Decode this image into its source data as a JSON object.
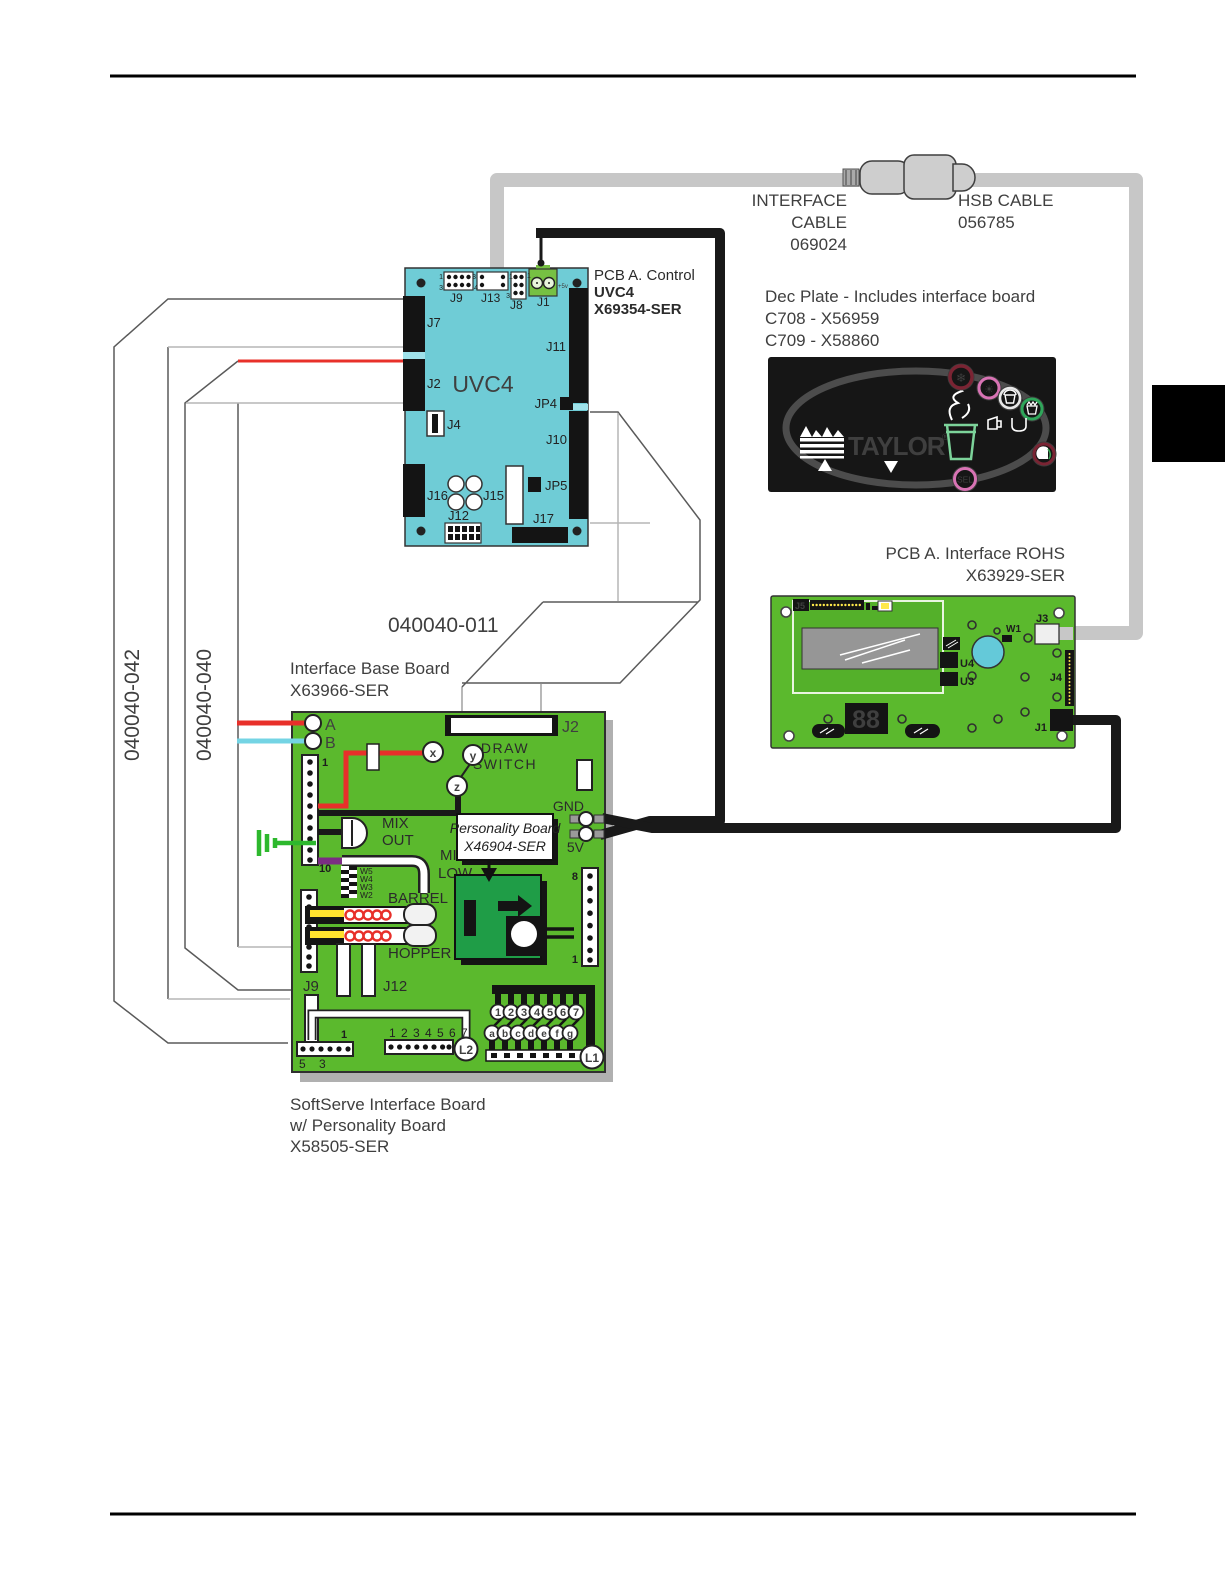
{
  "page": {
    "labels": {
      "harness_outer": "040040-042",
      "harness_inner": "040040-040",
      "harness_011": "040040-011"
    }
  },
  "cables": {
    "interface": {
      "line1": "INTERFACE",
      "line2": "CABLE",
      "line3": "069024"
    },
    "hsb": {
      "line1": "HSB CABLE",
      "line2": "056785"
    }
  },
  "uvc4": {
    "title1": "PCB A. Control",
    "title2": "UVC4",
    "title3": "X69354-SER",
    "chip_label": "UVC4",
    "j9": "J9",
    "j13": "J13",
    "j8": "J8",
    "j1": "J1",
    "j7": "J7",
    "j2": "J2",
    "j4": "J4",
    "j16": "J16",
    "j15": "J15",
    "j12": "J12",
    "j17": "J17",
    "j11": "J11",
    "jp4": "JP4",
    "jp5": "JP5",
    "j10": "J10",
    "pins": {
      "p1": "1",
      "p3": "3",
      "p4": "4",
      "p3b": "3",
      "p1b": "1",
      "p1c": "1",
      "p3c": "3",
      "plus5v": "+5v"
    }
  },
  "dec_plate": {
    "title": "Dec Plate - Includes interface board",
    "code1": "C708 - X56959",
    "code2": "C709 - X58860",
    "brand": "TAYLOR",
    "reg": "®",
    "sel": "SEL"
  },
  "rohs": {
    "title1": "PCB A. Interface ROHS",
    "title2": "X63929-SER",
    "j5": "J5",
    "w1": "W1",
    "u4": "U4",
    "u3": "U3",
    "j3": "J3",
    "j4": "J4",
    "j1": "J1",
    "display": "88"
  },
  "base": {
    "title1": "Interface Base Board",
    "title2": "X63966-SER",
    "wire_a": "A",
    "wire_b": "B",
    "j2": "J2",
    "draw": "DRAW",
    "switch": "SWITCH",
    "x": "x",
    "y": "y",
    "z": "z",
    "gnd": "GND",
    "v5": "5V",
    "mix": "MIX",
    "out": "OUT",
    "mix_low_1": "MIX",
    "mix_low_2": "LOW",
    "personality1": "Personality Board",
    "personality2": "X46904-SER",
    "w5": "W5",
    "w4": "W4",
    "w3": "W3",
    "w2": "W2",
    "barrel": "BARREL",
    "hopper": "HOPPER",
    "j9": "J9",
    "j12": "J12",
    "pin1": "1",
    "pin10": "10",
    "pin8": "8",
    "pin1_right": "1",
    "pin1_bottom": "1",
    "pin5": "5",
    "pin3": "3",
    "l2_row": "1 2 3 4 5 6 7",
    "l2": "L2",
    "l1": "L1",
    "digits": [
      "1",
      "2",
      "3",
      "4",
      "5",
      "6",
      "7"
    ],
    "letters": [
      "a",
      "b",
      "c",
      "d",
      "e",
      "f",
      "g"
    ]
  },
  "footer": {
    "line1": "SoftServe Interface Board",
    "line2": "w/ Personality Board",
    "line3": "X58505-SER"
  },
  "colors": {
    "board_green": "#5bb92d",
    "uvc4_cyan": "#6fccd6",
    "wire_red": "#e8302a",
    "wire_cyan": "#74d4e4",
    "wire_yellow": "#ffe12e",
    "wire_purple": "#7b2d83",
    "cable_gray": "#c7c7c7",
    "cable_black": "#191919",
    "ground_green": "#2db82d",
    "buzzer_blue": "#64c9d9"
  }
}
